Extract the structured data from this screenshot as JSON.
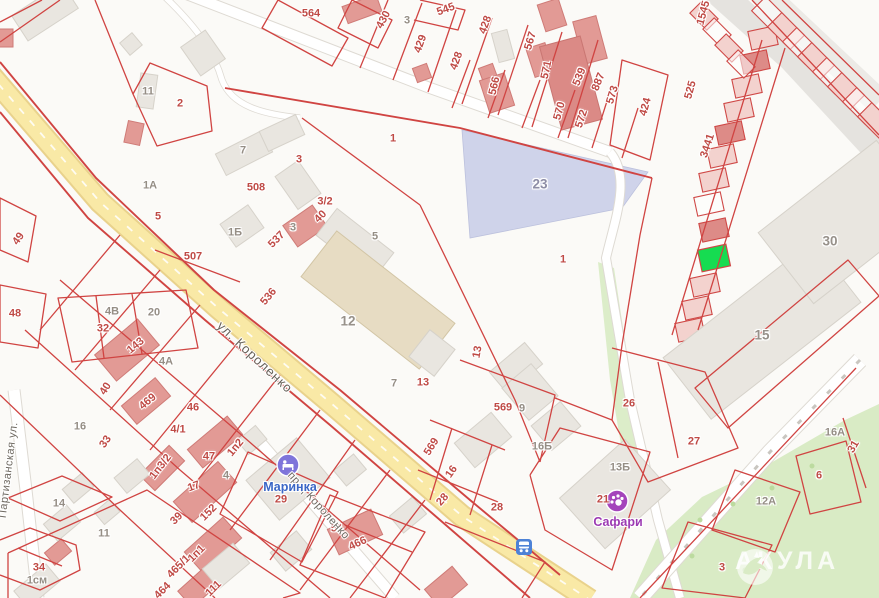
{
  "map": {
    "type": "cadastral-map",
    "accent_parcel_line_color": "#d04442",
    "highlight_parcel_color": "#16dc51",
    "main_road_color": "#f9e9a6",
    "park_color": "#d9ebc5",
    "parcel_23_fill": "#cfd3ea"
  },
  "watermark": {
    "text": "АКУЛА"
  },
  "streets": [
    {
      "name": "ул. Короленко"
    },
    {
      "name": "пр-д Короленко"
    },
    {
      "name": "Партизанская ул."
    }
  ],
  "pois": [
    {
      "name": "Маринка",
      "kind": "hotel",
      "color": "#7e74da"
    },
    {
      "name": "Сафари",
      "kind": "leisure",
      "color": "#a444bb"
    },
    {
      "name": "остановка",
      "kind": "bus-stop",
      "color": "#4d82d6"
    }
  ],
  "labels": [
    {
      "t": "564",
      "x": 311,
      "y": 14
    },
    {
      "t": "430",
      "x": 384,
      "y": 20,
      "r": -62
    },
    {
      "t": "3",
      "x": 407,
      "y": 21,
      "c": "b"
    },
    {
      "t": "545",
      "x": 446,
      "y": 10,
      "r": -20
    },
    {
      "t": "429",
      "x": 421,
      "y": 44,
      "r": -70
    },
    {
      "t": "428",
      "x": 486,
      "y": 25,
      "r": -70
    },
    {
      "t": "428",
      "x": 457,
      "y": 61,
      "r": -70
    },
    {
      "t": "566",
      "x": 495,
      "y": 86,
      "r": -77
    },
    {
      "t": "567",
      "x": 531,
      "y": 41,
      "r": -73
    },
    {
      "t": "571",
      "x": 547,
      "y": 70,
      "r": -78
    },
    {
      "t": "570",
      "x": 560,
      "y": 111,
      "r": -75
    },
    {
      "t": "539",
      "x": 580,
      "y": 77,
      "r": -68
    },
    {
      "t": "572",
      "x": 582,
      "y": 119,
      "r": -72
    },
    {
      "t": "887",
      "x": 599,
      "y": 82,
      "r": -68
    },
    {
      "t": "573",
      "x": 613,
      "y": 95,
      "r": -73
    },
    {
      "t": "424",
      "x": 646,
      "y": 107,
      "r": -75
    },
    {
      "t": "525",
      "x": 691,
      "y": 90,
      "r": -75
    },
    {
      "t": "1545",
      "x": 704,
      "y": 13,
      "r": -75
    },
    {
      "t": "3441",
      "x": 708,
      "y": 146,
      "r": -72
    },
    {
      "t": "1",
      "x": 393,
      "y": 139
    },
    {
      "t": "2",
      "x": 180,
      "y": 104
    },
    {
      "t": "11",
      "x": 148,
      "y": 92,
      "c": "b"
    },
    {
      "t": "1А",
      "x": 150,
      "y": 186,
      "c": "b"
    },
    {
      "t": "5",
      "x": 158,
      "y": 217
    },
    {
      "t": "508",
      "x": 256,
      "y": 188
    },
    {
      "t": "1Б",
      "x": 235,
      "y": 233,
      "c": "b"
    },
    {
      "t": "507",
      "x": 193,
      "y": 257
    },
    {
      "t": "537",
      "x": 277,
      "y": 240,
      "r": -45
    },
    {
      "t": "536",
      "x": 269,
      "y": 297,
      "r": -50
    },
    {
      "t": "3",
      "x": 299,
      "y": 160
    },
    {
      "t": "3/2",
      "x": 325,
      "y": 202
    },
    {
      "t": "40",
      "x": 321,
      "y": 217,
      "r": -45
    },
    {
      "t": "3",
      "x": 293,
      "y": 228,
      "c": "b"
    },
    {
      "t": "7",
      "x": 243,
      "y": 151,
      "c": "b"
    },
    {
      "t": "5",
      "x": 375,
      "y": 237,
      "c": "b"
    },
    {
      "t": "49",
      "x": 19,
      "y": 239,
      "r": -55
    },
    {
      "t": "48",
      "x": 15,
      "y": 314
    },
    {
      "t": "4В",
      "x": 112,
      "y": 312,
      "c": "b"
    },
    {
      "t": "20",
      "x": 154,
      "y": 313,
      "c": "b"
    },
    {
      "t": "32",
      "x": 103,
      "y": 329
    },
    {
      "t": "143",
      "x": 136,
      "y": 346,
      "r": -40
    },
    {
      "t": "4А",
      "x": 166,
      "y": 362,
      "c": "b"
    },
    {
      "t": "40",
      "x": 106,
      "y": 389,
      "r": -58
    },
    {
      "t": "469",
      "x": 148,
      "y": 402,
      "r": -40
    },
    {
      "t": "46",
      "x": 193,
      "y": 408
    },
    {
      "t": "16",
      "x": 80,
      "y": 427,
      "c": "b"
    },
    {
      "t": "33",
      "x": 106,
      "y": 442,
      "r": -55
    },
    {
      "t": "4/1",
      "x": 178,
      "y": 430
    },
    {
      "t": "1п3/2",
      "x": 161,
      "y": 467,
      "r": -52
    },
    {
      "t": "47",
      "x": 209,
      "y": 457
    },
    {
      "t": "1п2",
      "x": 236,
      "y": 448,
      "r": -50
    },
    {
      "t": "4",
      "x": 226,
      "y": 476,
      "c": "b"
    },
    {
      "t": "17",
      "x": 194,
      "y": 487,
      "r": -20
    },
    {
      "t": "152",
      "x": 209,
      "y": 513,
      "r": -45
    },
    {
      "t": "39",
      "x": 177,
      "y": 519,
      "r": -45
    },
    {
      "t": "11",
      "x": 104,
      "y": 534,
      "c": "b"
    },
    {
      "t": "14",
      "x": 59,
      "y": 504,
      "c": "b"
    },
    {
      "t": "34",
      "x": 39,
      "y": 568
    },
    {
      "t": "1см",
      "x": 37,
      "y": 581,
      "c": "b"
    },
    {
      "t": "465/1",
      "x": 179,
      "y": 567,
      "r": -45
    },
    {
      "t": "464",
      "x": 163,
      "y": 591,
      "r": -45
    },
    {
      "t": "1п1",
      "x": 197,
      "y": 554,
      "r": -45
    },
    {
      "t": "111",
      "x": 214,
      "y": 589,
      "r": -45
    },
    {
      "t": "51",
      "x": 337,
      "y": 529
    },
    {
      "t": "466",
      "x": 358,
      "y": 544,
      "r": -25
    },
    {
      "t": "12",
      "x": 348,
      "y": 321,
      "c": "bb"
    },
    {
      "t": "13",
      "x": 478,
      "y": 352,
      "r": -80
    },
    {
      "t": "7",
      "x": 394,
      "y": 384,
      "c": "b"
    },
    {
      "t": "13",
      "x": 423,
      "y": 383
    },
    {
      "t": "569",
      "x": 503,
      "y": 408
    },
    {
      "t": "9",
      "x": 522,
      "y": 409,
      "c": "b"
    },
    {
      "t": "569",
      "x": 432,
      "y": 447,
      "r": -58
    },
    {
      "t": "16",
      "x": 452,
      "y": 472,
      "r": -55
    },
    {
      "t": "28",
      "x": 443,
      "y": 500,
      "r": -48
    },
    {
      "t": "28",
      "x": 497,
      "y": 508
    },
    {
      "t": "16Б",
      "x": 542,
      "y": 447,
      "c": "b"
    },
    {
      "t": "23",
      "x": 540,
      "y": 184,
      "c": "bl"
    },
    {
      "t": "1",
      "x": 563,
      "y": 260
    },
    {
      "t": "26",
      "x": 629,
      "y": 404
    },
    {
      "t": "27",
      "x": 694,
      "y": 442
    },
    {
      "t": "13Б",
      "x": 620,
      "y": 468,
      "c": "b"
    },
    {
      "t": "21",
      "x": 603,
      "y": 500
    },
    {
      "t": "30",
      "x": 830,
      "y": 241,
      "c": "bb"
    },
    {
      "t": "15",
      "x": 762,
      "y": 335,
      "c": "bb"
    },
    {
      "t": "16А",
      "x": 835,
      "y": 433,
      "c": "b"
    },
    {
      "t": "6",
      "x": 819,
      "y": 476
    },
    {
      "t": "31",
      "x": 854,
      "y": 447,
      "r": -60
    },
    {
      "t": "3",
      "x": 722,
      "y": 568
    },
    {
      "t": "12А",
      "x": 766,
      "y": 502,
      "c": "b"
    },
    {
      "t": "ул. Короленко",
      "x": 255,
      "y": 357,
      "r": 43,
      "c": "s"
    },
    {
      "t": "пр-д Короленко",
      "x": 318,
      "y": 506,
      "r": 48,
      "c": "s2"
    },
    {
      "t": "Партизанская ул.",
      "x": 9,
      "y": 470,
      "r": -83,
      "c": "s2"
    },
    {
      "t": "Маринка",
      "x": 290,
      "y": 487,
      "c": "blue"
    },
    {
      "t": "29",
      "x": 281,
      "y": 500
    },
    {
      "t": "Сафари",
      "x": 618,
      "y": 522,
      "c": "purple"
    }
  ]
}
